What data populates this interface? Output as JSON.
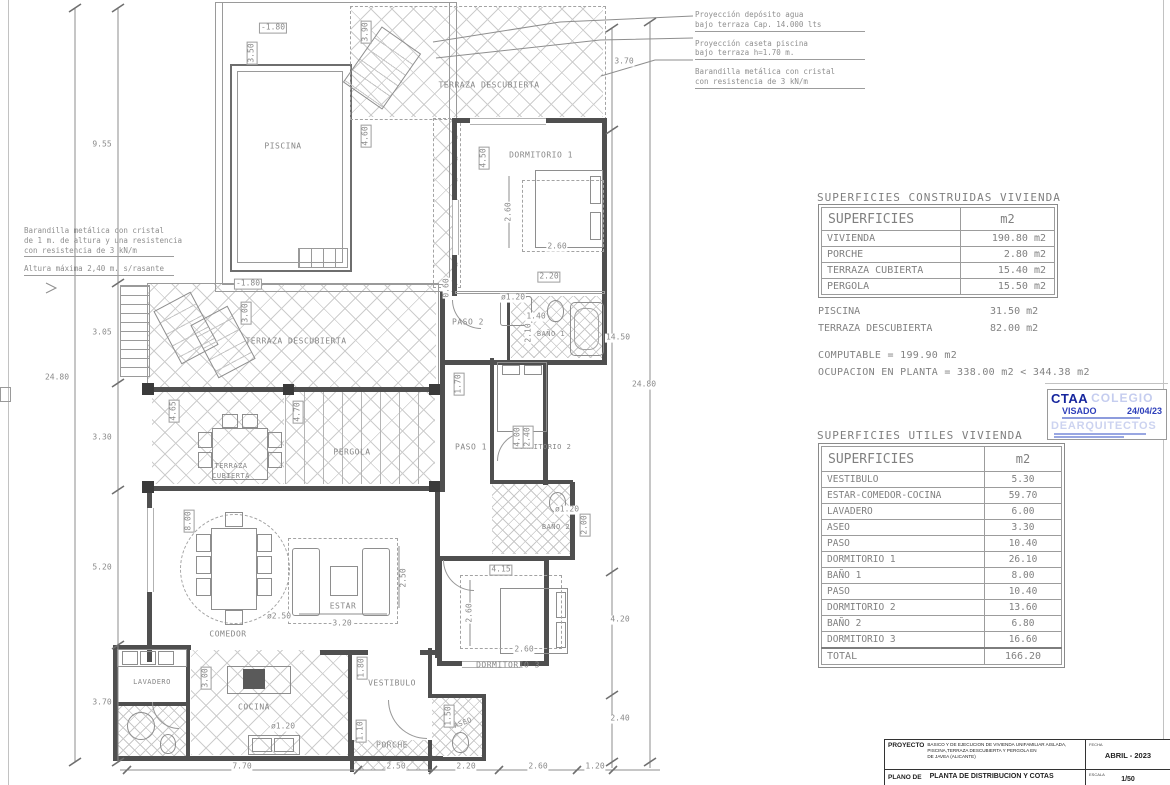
{
  "drawing": {
    "room_labels": [
      {
        "t": "PISCINA",
        "x": 283,
        "y": 146
      },
      {
        "t": "TERRAZA DESCUBIERTA",
        "x": 489,
        "y": 85
      },
      {
        "t": "TERRAZA DESCUBIERTA",
        "x": 296,
        "y": 341
      },
      {
        "t": "TERRAZA",
        "x": 231,
        "y": 466,
        "fs": 7
      },
      {
        "t": "CUBIERTA",
        "x": 231,
        "y": 476,
        "fs": 7
      },
      {
        "t": "PERGOLA",
        "x": 352,
        "y": 452
      },
      {
        "t": "DORMITORIO 1",
        "x": 541,
        "y": 155
      },
      {
        "t": "PASO 2",
        "x": 468,
        "y": 322
      },
      {
        "t": "BAÑO 1",
        "x": 551,
        "y": 334,
        "fs": 7
      },
      {
        "t": "PASO 1",
        "x": 471,
        "y": 447
      },
      {
        "t": "DORMITORIO 2",
        "x": 543,
        "y": 447,
        "fs": 7
      },
      {
        "t": "BAÑO 2",
        "x": 556,
        "y": 527,
        "fs": 7
      },
      {
        "t": "DORMITORIO 3",
        "x": 508,
        "y": 665
      },
      {
        "t": "ESTAR",
        "x": 343,
        "y": 606
      },
      {
        "t": "COMEDOR",
        "x": 228,
        "y": 634
      },
      {
        "t": "LAVADERO",
        "x": 152,
        "y": 682,
        "fs": 7
      },
      {
        "t": "COCINA",
        "x": 254,
        "y": 707
      },
      {
        "t": "VESTIBULO",
        "x": 392,
        "y": 683
      },
      {
        "t": "PORCHE",
        "x": 392,
        "y": 745
      },
      {
        "t": "ASEO",
        "x": 463,
        "y": 723,
        "r": -20,
        "fs": 7
      }
    ],
    "dim_labels": [
      {
        "t": "9.55",
        "x": 102,
        "y": 145
      },
      {
        "t": "3.05",
        "x": 102,
        "y": 333
      },
      {
        "t": "24.80",
        "x": 57,
        "y": 378
      },
      {
        "t": "3.30",
        "x": 102,
        "y": 438
      },
      {
        "t": "5.20",
        "x": 102,
        "y": 568
      },
      {
        "t": "3.70",
        "x": 102,
        "y": 703
      },
      {
        "t": "3.70",
        "x": 624,
        "y": 62
      },
      {
        "t": "14.50",
        "x": 618,
        "y": 338
      },
      {
        "t": "24.80",
        "x": 644,
        "y": 385
      },
      {
        "t": "4.20",
        "x": 620,
        "y": 620
      },
      {
        "t": "2.40",
        "x": 620,
        "y": 719
      },
      {
        "t": "7.70",
        "x": 242,
        "y": 767
      },
      {
        "t": "2.50",
        "x": 396,
        "y": 767
      },
      {
        "t": "2.20",
        "x": 466,
        "y": 767
      },
      {
        "t": "2.60",
        "x": 538,
        "y": 767
      },
      {
        "t": "1.20",
        "x": 595,
        "y": 767
      },
      {
        "t": "3.50",
        "x": 252,
        "y": 53,
        "r": -90,
        "b": 1
      },
      {
        "t": "-1.80",
        "x": 273,
        "y": 28,
        "b": 1
      },
      {
        "t": "-1.80",
        "x": 248,
        "y": 284,
        "b": 1
      },
      {
        "t": "3.90",
        "x": 366,
        "y": 32,
        "r": -90,
        "b": 1
      },
      {
        "t": "4.60",
        "x": 366,
        "y": 136,
        "r": -90,
        "b": 1
      },
      {
        "t": "4.50",
        "x": 484,
        "y": 158,
        "r": -90,
        "b": 1
      },
      {
        "t": "2.60",
        "x": 509,
        "y": 212,
        "r": -90
      },
      {
        "t": "2.60",
        "x": 557,
        "y": 247
      },
      {
        "t": "2.20",
        "x": 549,
        "y": 277,
        "b": 1
      },
      {
        "t": "ø1.20",
        "x": 513,
        "y": 298
      },
      {
        "t": "1.40",
        "x": 536,
        "y": 317
      },
      {
        "t": "2.10",
        "x": 529,
        "y": 333,
        "r": -90
      },
      {
        "t": "1.70",
        "x": 459,
        "y": 384,
        "r": -90,
        "b": 1
      },
      {
        "t": "4.00",
        "x": 518,
        "y": 437,
        "r": -90,
        "b": 1
      },
      {
        "t": "2.40",
        "x": 528,
        "y": 437,
        "r": -90,
        "b": 1
      },
      {
        "t": "ø1.20",
        "x": 567,
        "y": 510
      },
      {
        "t": "2.00",
        "x": 585,
        "y": 525,
        "r": -90,
        "b": 1
      },
      {
        "t": "4.15",
        "x": 501,
        "y": 570,
        "b": 1
      },
      {
        "t": "2.60",
        "x": 470,
        "y": 613,
        "r": -90
      },
      {
        "t": "2.60",
        "x": 524,
        "y": 650
      },
      {
        "t": "2.50",
        "x": 404,
        "y": 578,
        "r": -90
      },
      {
        "t": "3.20",
        "x": 342,
        "y": 624
      },
      {
        "t": "ø2.50",
        "x": 279,
        "y": 617
      },
      {
        "t": "8.00",
        "x": 189,
        "y": 521,
        "r": -90,
        "b": 1
      },
      {
        "t": "4.65",
        "x": 174,
        "y": 411,
        "r": -90,
        "b": 1
      },
      {
        "t": "4.70",
        "x": 298,
        "y": 412,
        "r": -90,
        "b": 1
      },
      {
        "t": "3.00",
        "x": 246,
        "y": 313,
        "r": -90,
        "b": 1
      },
      {
        "t": "1.80",
        "x": 362,
        "y": 668,
        "r": -90,
        "b": 1
      },
      {
        "t": "3.00",
        "x": 206,
        "y": 678,
        "r": -90,
        "b": 1
      },
      {
        "t": "1.50",
        "x": 449,
        "y": 716,
        "r": -90,
        "b": 1
      },
      {
        "t": "1.10",
        "x": 361,
        "y": 731,
        "r": -90,
        "b": 1
      },
      {
        "t": "ø1.20",
        "x": 283,
        "y": 727
      },
      {
        "t": "0.60",
        "x": 447,
        "y": 288,
        "r": -90
      }
    ],
    "annotations_top_right": [
      [
        "Proyección depósito agua",
        "bajo terraza Cap. 14.000 lts"
      ],
      [
        "Proyección caseta piscina",
        "bajo terraza h=1.70 m."
      ],
      [
        "Barandilla metálica con cristal",
        "con resistencia de  3 kN/m"
      ]
    ],
    "annotations_left": [
      [
        "Barandilla metálica con cristal",
        "de 1 m. de altura y una resistencia",
        "con resistencia de  3 kN/m"
      ],
      [
        "Altura máxima 2,40 m. s/rasante"
      ]
    ]
  },
  "tables": {
    "constructed": {
      "title": "SUPERFICIES CONSTRUIDAS VIVIENDA",
      "header": [
        "SUPERFICIES",
        "m2"
      ],
      "rows": [
        [
          "VIVIENDA",
          "190.80 m2"
        ],
        [
          "PORCHE",
          "2.80 m2"
        ],
        [
          "TERRAZA CUBIERTA",
          "15.40 m2"
        ],
        [
          "PERGOLA",
          "15.50 m2"
        ]
      ]
    },
    "useful": {
      "title": "SUPERFICIES UTILES VIVIENDA",
      "header": [
        "SUPERFICIES",
        "m2"
      ],
      "rows": [
        [
          "VESTIBULO",
          "5.30"
        ],
        [
          "ESTAR-COMEDOR-COCINA",
          "59.70"
        ],
        [
          "LAVADERO",
          "6.00"
        ],
        [
          "ASEO",
          "3.30"
        ],
        [
          "PASO",
          "10.40"
        ],
        [
          "DORMITORIO 1",
          "26.10"
        ],
        [
          "BAÑO 1",
          "8.00"
        ],
        [
          "PASO",
          "10.40"
        ],
        [
          "DORMITORIO 2",
          "13.60"
        ],
        [
          "BAÑO 2",
          "6.80"
        ],
        [
          "DORMITORIO 3",
          "16.60"
        ],
        [
          "TOTAL",
          "166.20"
        ]
      ]
    }
  },
  "summary": {
    "piscina": {
      "label": "PISCINA",
      "value": "31.50 m2"
    },
    "terraza": {
      "label": "TERRAZA DESCUBIERTA",
      "value": "82.00 m2"
    },
    "computable": "COMPUTABLE  =  199.90  m2",
    "ocupacion": "OCUPACION EN PLANTA  =  338.00  m2  <  344.38  m2"
  },
  "stamp": {
    "org": "CTAA",
    "wm_top": "COLEGIO",
    "visado": "VISADO",
    "date": "24/04/23",
    "wm_bottom": "DEARQUITECTOS"
  },
  "titleblock": {
    "project_label": "PROYECTO",
    "project_line1": "BASICO Y DE EJECUCION DE VIVIENDA UNIFAMILIAR AISLADA,",
    "project_line2": "PISCINA,TERRAZA DESCUBIERTA Y PERGOLA EN",
    "project_line3": "DE JAVEA (ALICANTE)",
    "fecha_label": "FECHA",
    "fecha": "ABRIL - 2023",
    "plano_label": "PLANO DE",
    "plano": "PLANTA DE DISTRIBUCION Y COTAS",
    "escala_label": "ESCALA",
    "escala": "1/50"
  }
}
